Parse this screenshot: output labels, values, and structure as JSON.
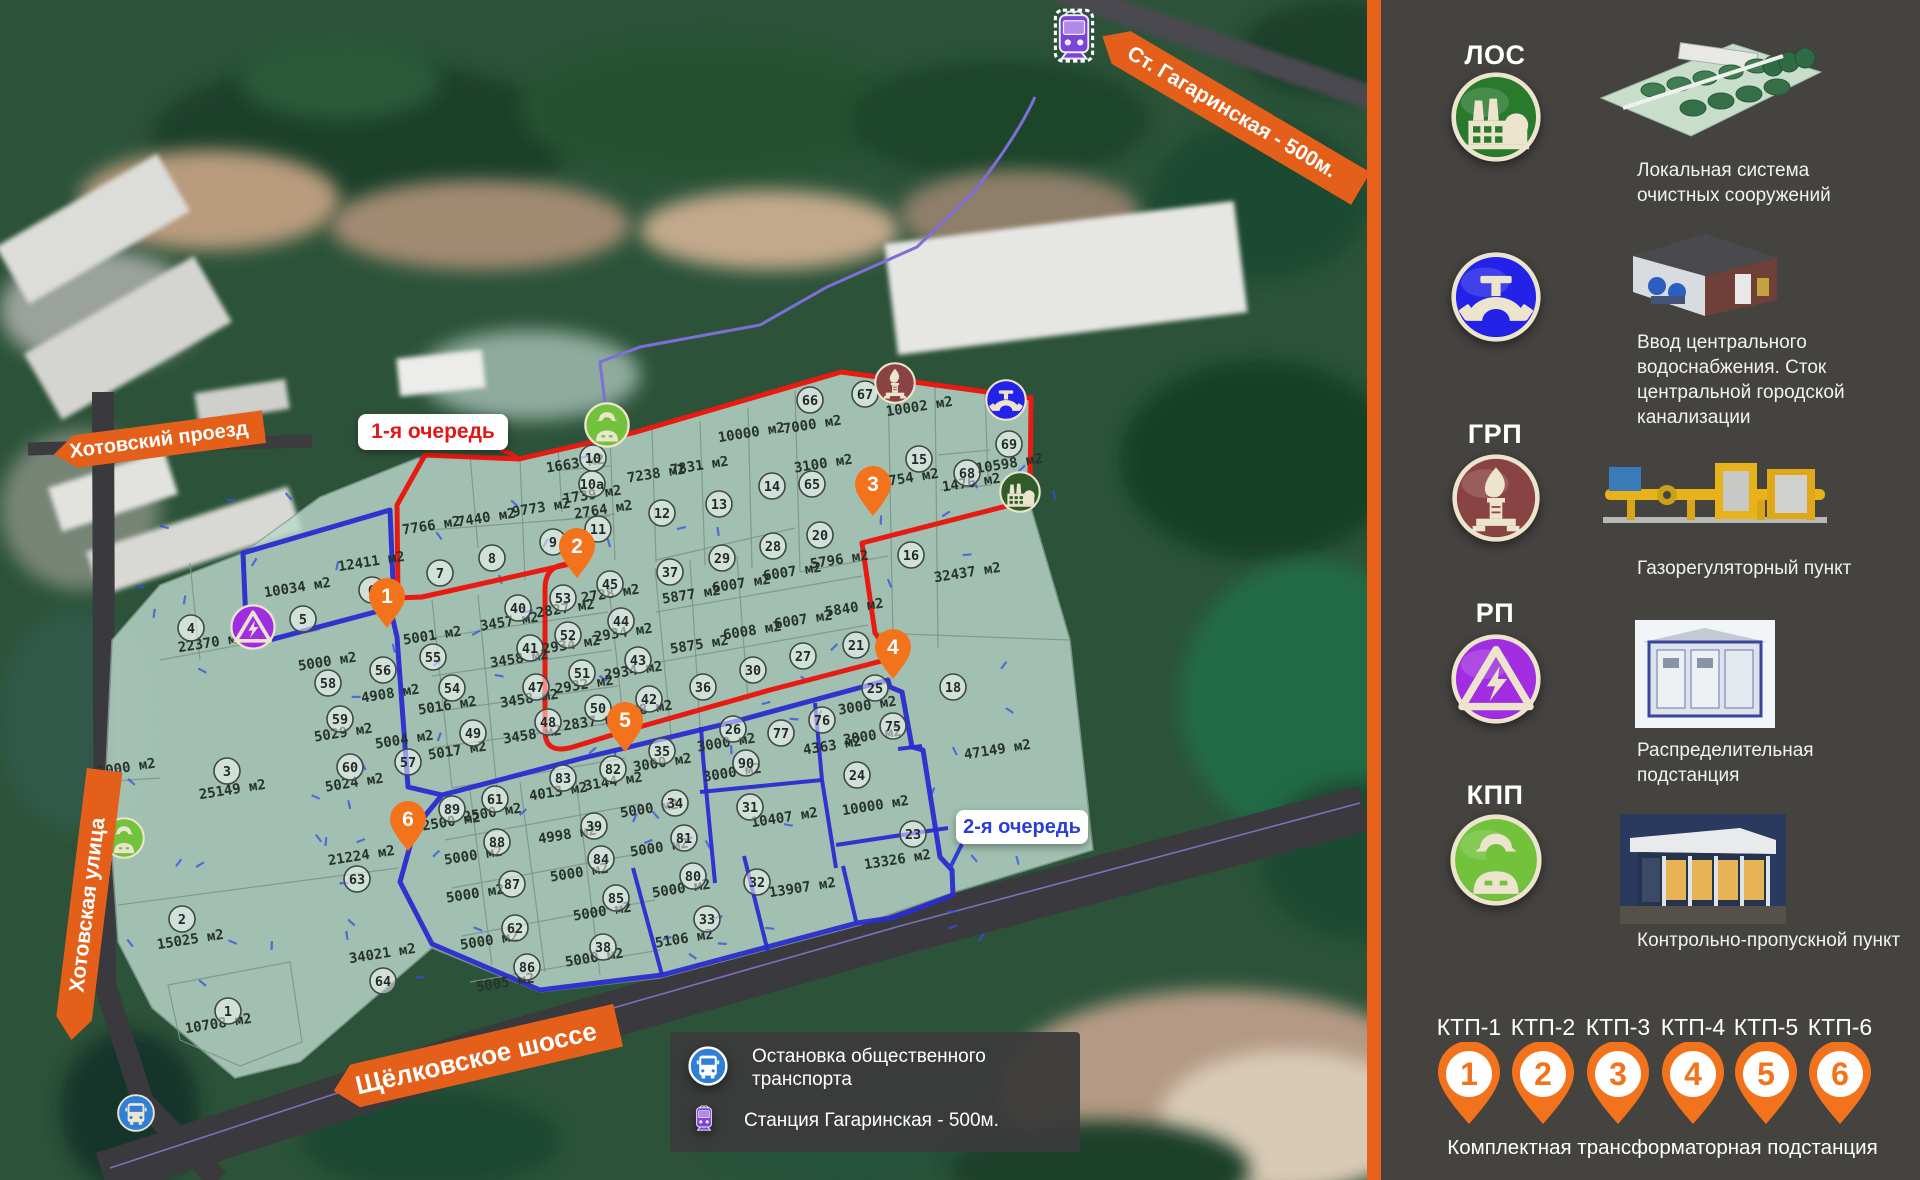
{
  "colors": {
    "accent_orange": "#e4601a",
    "phase1_red": "#e81b12",
    "phase2_blue": "#2b2bd0",
    "overlay_green": "#bcd9cc",
    "sidebar_bg": "#454340",
    "pin_orange": "#f3731d",
    "route_purple": "#7e6fd8",
    "label_red": "#e01818",
    "label_blue": "#2b3fd6"
  },
  "sidebar": {
    "sections": [
      {
        "abbr": "ЛОС",
        "icon": "factory-icon",
        "desc": "Локальная система очистных сооружений"
      },
      {
        "abbr": "",
        "icon": "water-tap-icon",
        "desc": "Ввод центрального водоснабжения. Сток центральной городской канализации"
      },
      {
        "abbr": "ГРП",
        "icon": "gas-flame-icon",
        "desc": "Газорегуляторный пункт"
      },
      {
        "abbr": "РП",
        "icon": "electric-hazard-icon",
        "desc": "Распределительная подстанция"
      },
      {
        "abbr": "КПП",
        "icon": "worker-icon",
        "desc": "Контрольно-пропускной пункт"
      }
    ],
    "ktp": {
      "labels": [
        "КТП-1",
        "КТП-2",
        "КТП-3",
        "КТП-4",
        "КТП-5",
        "КТП-6"
      ],
      "numbers": [
        "1",
        "2",
        "3",
        "4",
        "5",
        "6"
      ],
      "caption": "Комплектная трансформаторная подстанция"
    }
  },
  "map": {
    "banners": {
      "station": "Ст. Гагаринская - 500м.",
      "proezd": "Хотовский проезд",
      "ulitsa": "Хотовская улица",
      "shosse": "Щёлковское шоссе"
    },
    "phases": {
      "first": "1-я очередь",
      "second": "2-я очередь"
    },
    "legend": [
      {
        "icon": "bus-icon",
        "text": "Остановка общественного транспорта"
      },
      {
        "icon": "tram-icon",
        "text": "Станция  Гагаринская - 500м."
      }
    ],
    "plots": [
      [
        "1",
        228,
        1011
      ],
      [
        "2",
        182,
        919
      ],
      [
        "3",
        227,
        771
      ],
      [
        "4",
        191,
        628
      ],
      [
        "5",
        303,
        619
      ],
      [
        "6",
        372,
        590
      ],
      [
        "7",
        440,
        573
      ],
      [
        "8",
        492,
        558
      ],
      [
        "9",
        553,
        542
      ],
      [
        "10",
        593,
        458
      ],
      [
        "10a",
        592,
        484
      ],
      [
        "11",
        598,
        529
      ],
      [
        "12",
        662,
        513
      ],
      [
        "13",
        719,
        504
      ],
      [
        "14",
        772,
        486
      ],
      [
        "15",
        919,
        459
      ],
      [
        "16",
        911,
        555
      ],
      [
        "18",
        953,
        687
      ],
      [
        "20",
        820,
        535
      ],
      [
        "21",
        856,
        645
      ],
      [
        "23",
        913,
        834
      ],
      [
        "24",
        857,
        775
      ],
      [
        "25",
        875,
        688
      ],
      [
        "26",
        733,
        729
      ],
      [
        "27",
        803,
        656
      ],
      [
        "28",
        773,
        546
      ],
      [
        "29",
        722,
        558
      ],
      [
        "30",
        753,
        670
      ],
      [
        "31",
        750,
        807
      ],
      [
        "32",
        757,
        882
      ],
      [
        "33",
        707,
        919
      ],
      [
        "34",
        675,
        803
      ],
      [
        "35",
        662,
        751
      ],
      [
        "36",
        703,
        687
      ],
      [
        "37",
        670,
        572
      ],
      [
        "38",
        603,
        947
      ],
      [
        "39",
        594,
        826
      ],
      [
        "40",
        518,
        608
      ],
      [
        "41",
        530,
        648
      ],
      [
        "42",
        649,
        699
      ],
      [
        "43",
        638,
        660
      ],
      [
        "44",
        621,
        621
      ],
      [
        "45",
        610,
        584
      ],
      [
        "47",
        536,
        687
      ],
      [
        "48",
        548,
        722
      ],
      [
        "49",
        473,
        733
      ],
      [
        "50",
        598,
        708
      ],
      [
        "51",
        582,
        673
      ],
      [
        "52",
        568,
        635
      ],
      [
        "53",
        563,
        598
      ],
      [
        "54",
        452,
        688
      ],
      [
        "55",
        433,
        657
      ],
      [
        "56",
        383,
        670
      ],
      [
        "57",
        408,
        762
      ],
      [
        "58",
        328,
        683
      ],
      [
        "59",
        340,
        719
      ],
      [
        "60",
        350,
        767
      ],
      [
        "61",
        495,
        799
      ],
      [
        "62",
        515,
        928
      ],
      [
        "63",
        357,
        879
      ],
      [
        "64",
        383,
        981
      ],
      [
        "65",
        812,
        484
      ],
      [
        "66",
        810,
        400
      ],
      [
        "67",
        865,
        394
      ],
      [
        "68",
        967,
        473
      ],
      [
        "69",
        1009,
        444
      ],
      [
        "75",
        893,
        726
      ],
      [
        "76",
        822,
        720
      ],
      [
        "77",
        781,
        733
      ],
      [
        "80",
        693,
        876
      ],
      [
        "81",
        684,
        838
      ],
      [
        "82",
        613,
        769
      ],
      [
        "83",
        563,
        778
      ],
      [
        "84",
        601,
        859
      ],
      [
        "85",
        616,
        898
      ],
      [
        "86",
        527,
        967
      ],
      [
        "87",
        512,
        884
      ],
      [
        "88",
        497,
        842
      ],
      [
        "89",
        452,
        809
      ],
      [
        "90",
        746,
        763
      ]
    ],
    "areas": [
      [
        "1663 м2",
        576,
        468
      ],
      [
        "1739 м2",
        593,
        499
      ],
      [
        "2764 м2",
        604,
        514
      ],
      [
        "9773 м2",
        542,
        512
      ],
      [
        "7440 м2",
        487,
        522
      ],
      [
        "7766 м2",
        432,
        530
      ],
      [
        "7238 м2",
        657,
        478
      ],
      [
        "7831 м2",
        700,
        470
      ],
      [
        "10000 м2",
        752,
        437
      ],
      [
        "7000 м2",
        813,
        429
      ],
      [
        "3100 м2",
        824,
        468
      ],
      [
        "10002 м2",
        920,
        411
      ],
      [
        "10598 м2",
        1010,
        468
      ],
      [
        "12754 м2",
        906,
        483
      ],
      [
        "1476 м2",
        972,
        487
      ],
      [
        "12411 м2",
        372,
        566
      ],
      [
        "10034 м2",
        298,
        592
      ],
      [
        "22370 м2",
        212,
        647
      ],
      [
        "5001 м2",
        433,
        640
      ],
      [
        "5000 м2",
        328,
        666
      ],
      [
        "4908 м2",
        391,
        698
      ],
      [
        "5016 м2",
        448,
        710
      ],
      [
        "5004 м2",
        405,
        744
      ],
      [
        "5017 м2",
        458,
        755
      ],
      [
        "5029 м2",
        344,
        737
      ],
      [
        "5024 м2",
        355,
        787
      ],
      [
        "25149 м2",
        233,
        794
      ],
      [
        "5000 м2",
        127,
        772
      ],
      [
        "2728 м2",
        611,
        598
      ],
      [
        "2827 м2",
        566,
        613
      ],
      [
        "3457 м2",
        510,
        626
      ],
      [
        "3458 м2",
        520,
        663
      ],
      [
        "3458 м2",
        530,
        703
      ],
      [
        "3458 м2",
        533,
        739
      ],
      [
        "2934 м2",
        572,
        649
      ],
      [
        "2932 м2",
        585,
        689
      ],
      [
        "2837 м2",
        593,
        726
      ],
      [
        "2934 м2",
        624,
        637
      ],
      [
        "2934 м2",
        634,
        675
      ],
      [
        "2838 м2",
        644,
        714
      ],
      [
        "5877 м2",
        692,
        599
      ],
      [
        "6007 м2",
        793,
        576
      ],
      [
        "6007 м2",
        742,
        588
      ],
      [
        "6007 м2",
        804,
        624
      ],
      [
        "6008 м2",
        753,
        635
      ],
      [
        "5875 м2",
        700,
        649
      ],
      [
        "5796 м2",
        840,
        564
      ],
      [
        "5840 м2",
        855,
        612
      ],
      [
        "32437 м2",
        968,
        577
      ],
      [
        "47149 м2",
        998,
        754
      ],
      [
        "3000 м2",
        663,
        767
      ],
      [
        "3144 м2",
        614,
        786
      ],
      [
        "4013 м2",
        559,
        796
      ],
      [
        "3000 м2",
        727,
        747
      ],
      [
        "3000 м2",
        733,
        777
      ],
      [
        "5000 м2",
        650,
        813
      ],
      [
        "4363 м2",
        833,
        750
      ],
      [
        "3000 м2",
        868,
        710
      ],
      [
        "3000 м2",
        873,
        740
      ],
      [
        "2500 м2",
        493,
        817
      ],
      [
        "2500 м2",
        452,
        826
      ],
      [
        "5000 м2",
        474,
        860
      ],
      [
        "4998 м2",
        568,
        839
      ],
      [
        "5000 м2",
        580,
        877
      ],
      [
        "5000 м2",
        660,
        852
      ],
      [
        "5000 м2",
        476,
        898
      ],
      [
        "5000 м2",
        603,
        916
      ],
      [
        "5000 м2",
        682,
        893
      ],
      [
        "5106 м2",
        685,
        943
      ],
      [
        "5000 м2",
        490,
        945
      ],
      [
        "5000 м2",
        595,
        962
      ],
      [
        "5005 м2",
        506,
        987
      ],
      [
        "10407 м2",
        785,
        822
      ],
      [
        "10000 м2",
        876,
        810
      ],
      [
        "13326 м2",
        898,
        864
      ],
      [
        "13907 м2",
        803,
        892
      ],
      [
        "21224 м2",
        362,
        860
      ],
      [
        "34021 м2",
        383,
        958
      ],
      [
        "15025 м2",
        191,
        944
      ],
      [
        "10708 м2",
        219,
        1028
      ]
    ],
    "pins": [
      [
        "1",
        387,
        600
      ],
      [
        "2",
        577,
        550
      ],
      [
        "3",
        873,
        488
      ],
      [
        "4",
        893,
        651
      ],
      [
        "5",
        625,
        724
      ],
      [
        "6",
        408,
        823
      ]
    ],
    "icons": [
      {
        "type": "worker-icon",
        "x": 607,
        "y": 425,
        "r": 23
      },
      {
        "type": "worker-icon",
        "x": 124,
        "y": 838,
        "r": 21
      },
      {
        "type": "gas-flame-icon",
        "x": 895,
        "y": 383,
        "r": 21
      },
      {
        "type": "water-tap-icon",
        "x": 1006,
        "y": 400,
        "r": 21
      },
      {
        "type": "factory-icon",
        "x": 1020,
        "y": 492,
        "r": 21
      },
      {
        "type": "electric-hazard-icon",
        "x": 253,
        "y": 627,
        "r": 23
      },
      {
        "type": "bus-icon",
        "x": 136,
        "y": 1113,
        "r": 19
      },
      {
        "type": "tram-icon",
        "x": 1073,
        "y": 48
      }
    ]
  }
}
